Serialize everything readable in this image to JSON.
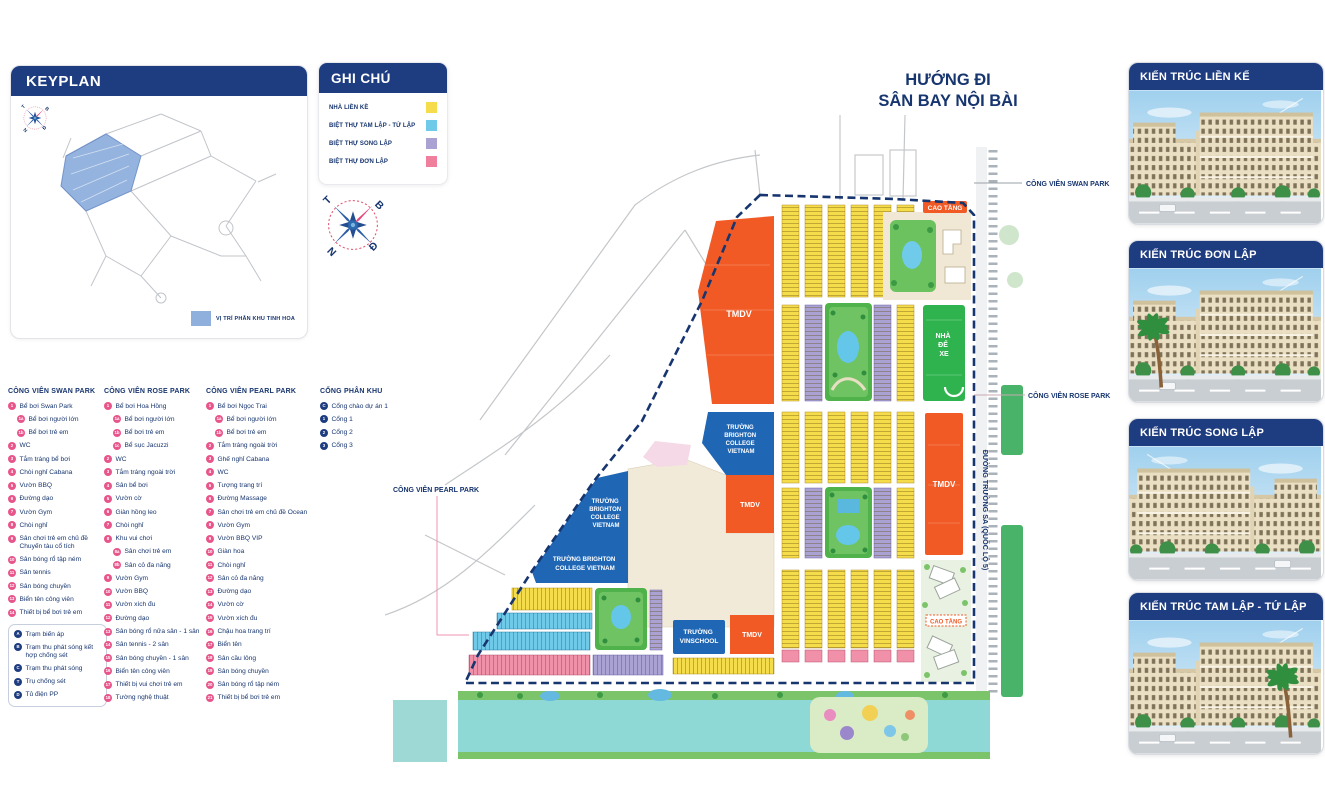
{
  "keyplan": {
    "title": "KEYPLAN",
    "legend_label": "VỊ TRÍ PHÂN KHU TINH HOA"
  },
  "legend": {
    "title": "GHI CHÚ",
    "items": [
      {
        "label": "NHÀ LIỀN KỀ",
        "color": "#f5dc4a"
      },
      {
        "label": "BIỆT THỰ TAM LẬP - TỨ LẬP",
        "color": "#6fc9e9"
      },
      {
        "label": "BIỆT THỰ SONG LẬP",
        "color": "#a9a2d3"
      },
      {
        "label": "BIỆT THỰ ĐƠN LẬP",
        "color": "#f07f9d"
      }
    ]
  },
  "compass": {
    "north": "B",
    "west": "T",
    "south": "N",
    "east": "Đ"
  },
  "parks": [
    {
      "title": "CÔNG VIÊN SWAN PARK",
      "badge_color": "#e8558a",
      "items": [
        {
          "n": "1",
          "label": "Bể bơi Swan Park"
        },
        {
          "n": "1a",
          "label": "Bể bơi người lớn",
          "sub": true
        },
        {
          "n": "1b",
          "label": "Bể bơi trẻ em",
          "sub": true
        },
        {
          "n": "2",
          "label": "WC"
        },
        {
          "n": "3",
          "label": "Tắm tráng bể bơi"
        },
        {
          "n": "4",
          "label": "Chòi nghỉ Cabana"
        },
        {
          "n": "5",
          "label": "Vườn BBQ"
        },
        {
          "n": "6",
          "label": "Đường dạo"
        },
        {
          "n": "7",
          "label": "Vườn Gym"
        },
        {
          "n": "8",
          "label": "Chòi nghỉ"
        },
        {
          "n": "9",
          "label": "Sân chơi trẻ em chủ đề Chuyến tàu cổ tích"
        },
        {
          "n": "10",
          "label": "Sân bóng rổ tập ném"
        },
        {
          "n": "11",
          "label": "Sân tennis"
        },
        {
          "n": "12",
          "label": "Sân bóng chuyền"
        },
        {
          "n": "13",
          "label": "Biển tên công viên"
        },
        {
          "n": "14",
          "label": "Thiết bị bể bơi trẻ em"
        }
      ]
    },
    {
      "title": "CÔNG VIÊN ROSE PARK",
      "badge_color": "#e8558a",
      "items": [
        {
          "n": "1",
          "label": "Bể bơi Hoa Hồng"
        },
        {
          "n": "1a",
          "label": "Bể bơi người lớn",
          "sub": true
        },
        {
          "n": "1b",
          "label": "Bể bơi trẻ em",
          "sub": true
        },
        {
          "n": "1c",
          "label": "Bể sục Jacuzzi",
          "sub": true
        },
        {
          "n": "2",
          "label": "WC"
        },
        {
          "n": "3",
          "label": "Tắm tráng ngoài trời"
        },
        {
          "n": "4",
          "label": "Sân bể bơi"
        },
        {
          "n": "5",
          "label": "Vườn cờ"
        },
        {
          "n": "6",
          "label": "Giàn hồng leo"
        },
        {
          "n": "7",
          "label": "Chòi nghỉ"
        },
        {
          "n": "8",
          "label": "Khu vui chơi"
        },
        {
          "n": "8a",
          "label": "Sân chơi trẻ em",
          "sub": true
        },
        {
          "n": "8b",
          "label": "Sân cỏ đa năng",
          "sub": true
        },
        {
          "n": "9",
          "label": "Vườn Gym"
        },
        {
          "n": "10",
          "label": "Vườn BBQ"
        },
        {
          "n": "11",
          "label": "Vườn xích đu"
        },
        {
          "n": "12",
          "label": "Đường dạo"
        },
        {
          "n": "13",
          "label": "Sân bóng rổ nửa sân - 1 sân"
        },
        {
          "n": "14",
          "label": "Sân tennis - 2 sân"
        },
        {
          "n": "15",
          "label": "Sân bóng chuyền - 1 sân"
        },
        {
          "n": "16",
          "label": "Biển tên công viên"
        },
        {
          "n": "17",
          "label": "Thiết bị vui chơi trẻ em"
        },
        {
          "n": "18",
          "label": "Tường nghệ thuật"
        }
      ]
    },
    {
      "title": "CÔNG VIÊN PEARL PARK",
      "badge_color": "#e8558a",
      "items": [
        {
          "n": "1",
          "label": "Bể bơi Ngọc Trai"
        },
        {
          "n": "1a",
          "label": "Bể bơi người lớn",
          "sub": true
        },
        {
          "n": "1b",
          "label": "Bể bơi trẻ em",
          "sub": true
        },
        {
          "n": "2",
          "label": "Tắm tráng ngoài trời"
        },
        {
          "n": "3",
          "label": "Ghế nghỉ Cabana"
        },
        {
          "n": "4",
          "label": "WC"
        },
        {
          "n": "5",
          "label": "Tượng trang trí"
        },
        {
          "n": "6",
          "label": "Đường Massage"
        },
        {
          "n": "7",
          "label": "Sân chơi trẻ em chủ đề Ocean"
        },
        {
          "n": "8",
          "label": "Vườn Gym"
        },
        {
          "n": "9",
          "label": "Vườn BBQ VIP"
        },
        {
          "n": "10",
          "label": "Giàn hoa"
        },
        {
          "n": "11",
          "label": "Chòi nghỉ"
        },
        {
          "n": "12",
          "label": "Sân cỏ đa năng"
        },
        {
          "n": "13",
          "label": "Đường dạo"
        },
        {
          "n": "14",
          "label": "Vườn cờ"
        },
        {
          "n": "15",
          "label": "Vườn xích đu"
        },
        {
          "n": "16",
          "label": "Chậu hoa trang trí"
        },
        {
          "n": "17",
          "label": "Biển tên"
        },
        {
          "n": "18",
          "label": "Sân cầu lông"
        },
        {
          "n": "19",
          "label": "Sân bóng chuyền"
        },
        {
          "n": "20",
          "label": "Sân bóng rổ tập ném"
        },
        {
          "n": "21",
          "label": "Thiết bị bể bơi trẻ em"
        }
      ]
    },
    {
      "title": "CỔNG PHÂN KHU",
      "badge_color": "#1e3c80",
      "items": [
        {
          "n": "C",
          "label": "Cổng chào dự án 1"
        },
        {
          "n": "1",
          "label": "Cổng 1"
        },
        {
          "n": "2",
          "label": "Cổng 2"
        },
        {
          "n": "3",
          "label": "Cổng 3"
        }
      ]
    }
  ],
  "utilities": {
    "badge_color": "#1e3c80",
    "items": [
      {
        "n": "A",
        "label": "Trạm biến áp"
      },
      {
        "n": "B",
        "label": "Trạm thu phát sóng kết hợp chống sét"
      },
      {
        "n": "C",
        "label": "Trạm thu phát sóng"
      },
      {
        "n": "T",
        "label": "Trụ chống sét"
      },
      {
        "n": "D",
        "label": "Tủ điện PP"
      }
    ]
  },
  "map": {
    "direction": [
      "HƯỚNG ĐI",
      "SÂN BAY NỘI BÀI"
    ],
    "labels": {
      "swan_park": "CÔNG VIÊN SWAN PARK",
      "rose_park": "CÔNG VIÊN ROSE PARK",
      "pearl_park": "CÔNG VIÊN PEARL PARK",
      "road_vertical": "ĐƯỜNG TRƯỜNG SA (QUỐC LỘ 5)",
      "cao_tang": "CAO TẦNG",
      "tmdv": "TMDV",
      "nha_de_xe": [
        "NHÀ",
        "ĐỂ",
        "XE"
      ],
      "brighton": [
        "TRƯỜNG",
        "BRIGHTON",
        "COLLEGE",
        "VIETNAM"
      ],
      "brighton2": [
        "TRƯỜNG BRIGHTON",
        "COLLEGE VIETNAM"
      ],
      "vinschool": [
        "TRƯỜNG",
        "VINSCHOOL"
      ]
    }
  },
  "cards": [
    {
      "title": "KIẾN TRÚC LIỀN KẾ"
    },
    {
      "title": "KIẾN TRÚC ĐƠN LẬP"
    },
    {
      "title": "KIẾN TRÚC SONG LẬP"
    },
    {
      "title": "KIẾN TRÚC TAM LẬP - TỨ LẬP"
    }
  ],
  "colors": {
    "navy": "#1e3c80",
    "orange": "#f15a25",
    "yellow": "#f5dc4a",
    "cyan": "#6fc9e9",
    "lavender": "#a9a2d3",
    "pink": "#f07f9d",
    "school_blue": "#1f66b5",
    "green": "#2eb34f",
    "canal": "#8ed8d5",
    "badge_pink": "#e8558a"
  }
}
